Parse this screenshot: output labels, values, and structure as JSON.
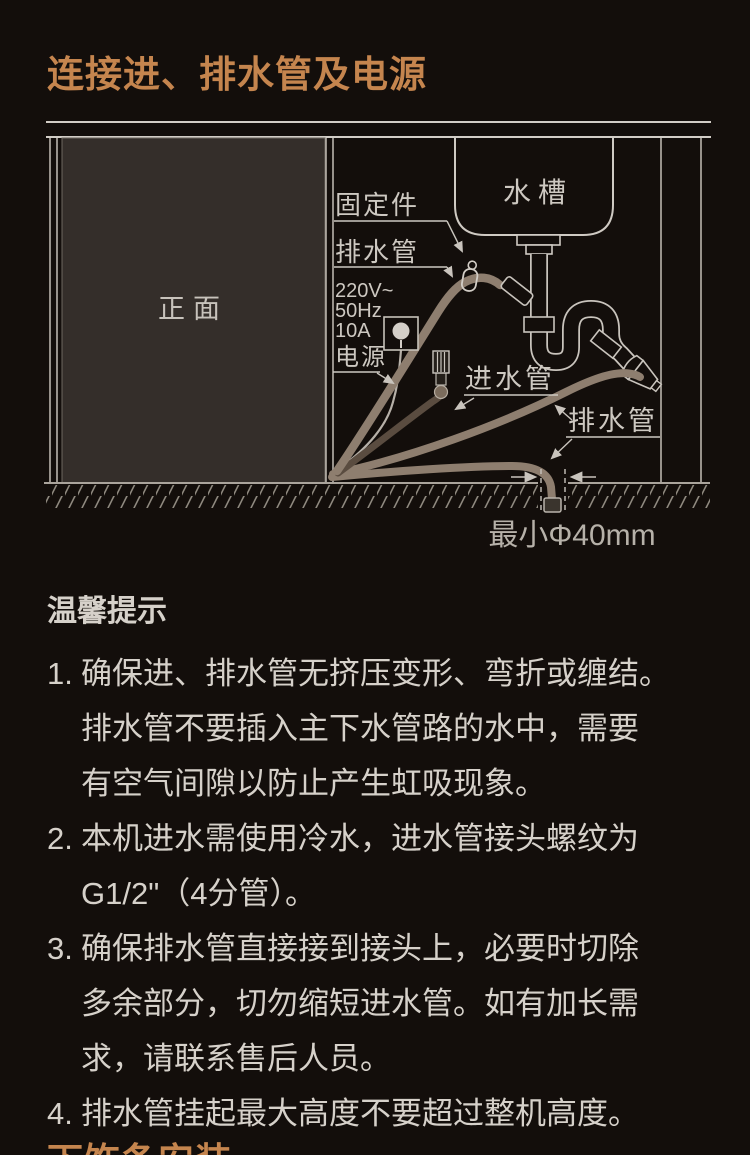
{
  "page": {
    "bg_color": "#130e0b",
    "accent_color": "#c5854e",
    "text_color": "#d6d1ca"
  },
  "title": "连接进、排水管及电源",
  "diagram": {
    "front_label": "正面",
    "sink_label": "水槽",
    "fixing_label": "固定件",
    "drain_label_left": "排水管",
    "power_specs": [
      "220V~",
      "50Hz",
      "10A"
    ],
    "power_label": "电源",
    "inlet_label": "进水管",
    "drain_label_right": "排水管",
    "min_diameter_label": "最小Φ40mm",
    "line_color": "#c9c4bd",
    "hose_color": "#8e7e6f",
    "inlet_hose_color": "#5a4c40"
  },
  "tips": {
    "heading": "温馨提示",
    "items": [
      {
        "num": "1.",
        "lines": [
          "确保进、排水管无挤压变形、弯折或缠结。",
          "排水管不要插入主下水管路的水中，需要",
          "有空气间隙以防止产生虹吸现象。"
        ]
      },
      {
        "num": "2.",
        "lines": [
          "本机进水需使用冷水，进水管接头螺纹为",
          "G1/2\"（4分管）。"
        ]
      },
      {
        "num": "3.",
        "lines": [
          "确保排水管直接接到接头上，必要时切除",
          "多余部分，切勿缩短进水管。如有加长需",
          "求，请联系售后人员。"
        ]
      },
      {
        "num": "4.",
        "lines": [
          "排水管挂起最大高度不要超过整机高度。"
        ]
      }
    ]
  },
  "next_section": {
    "heading": "下饰条安装"
  }
}
